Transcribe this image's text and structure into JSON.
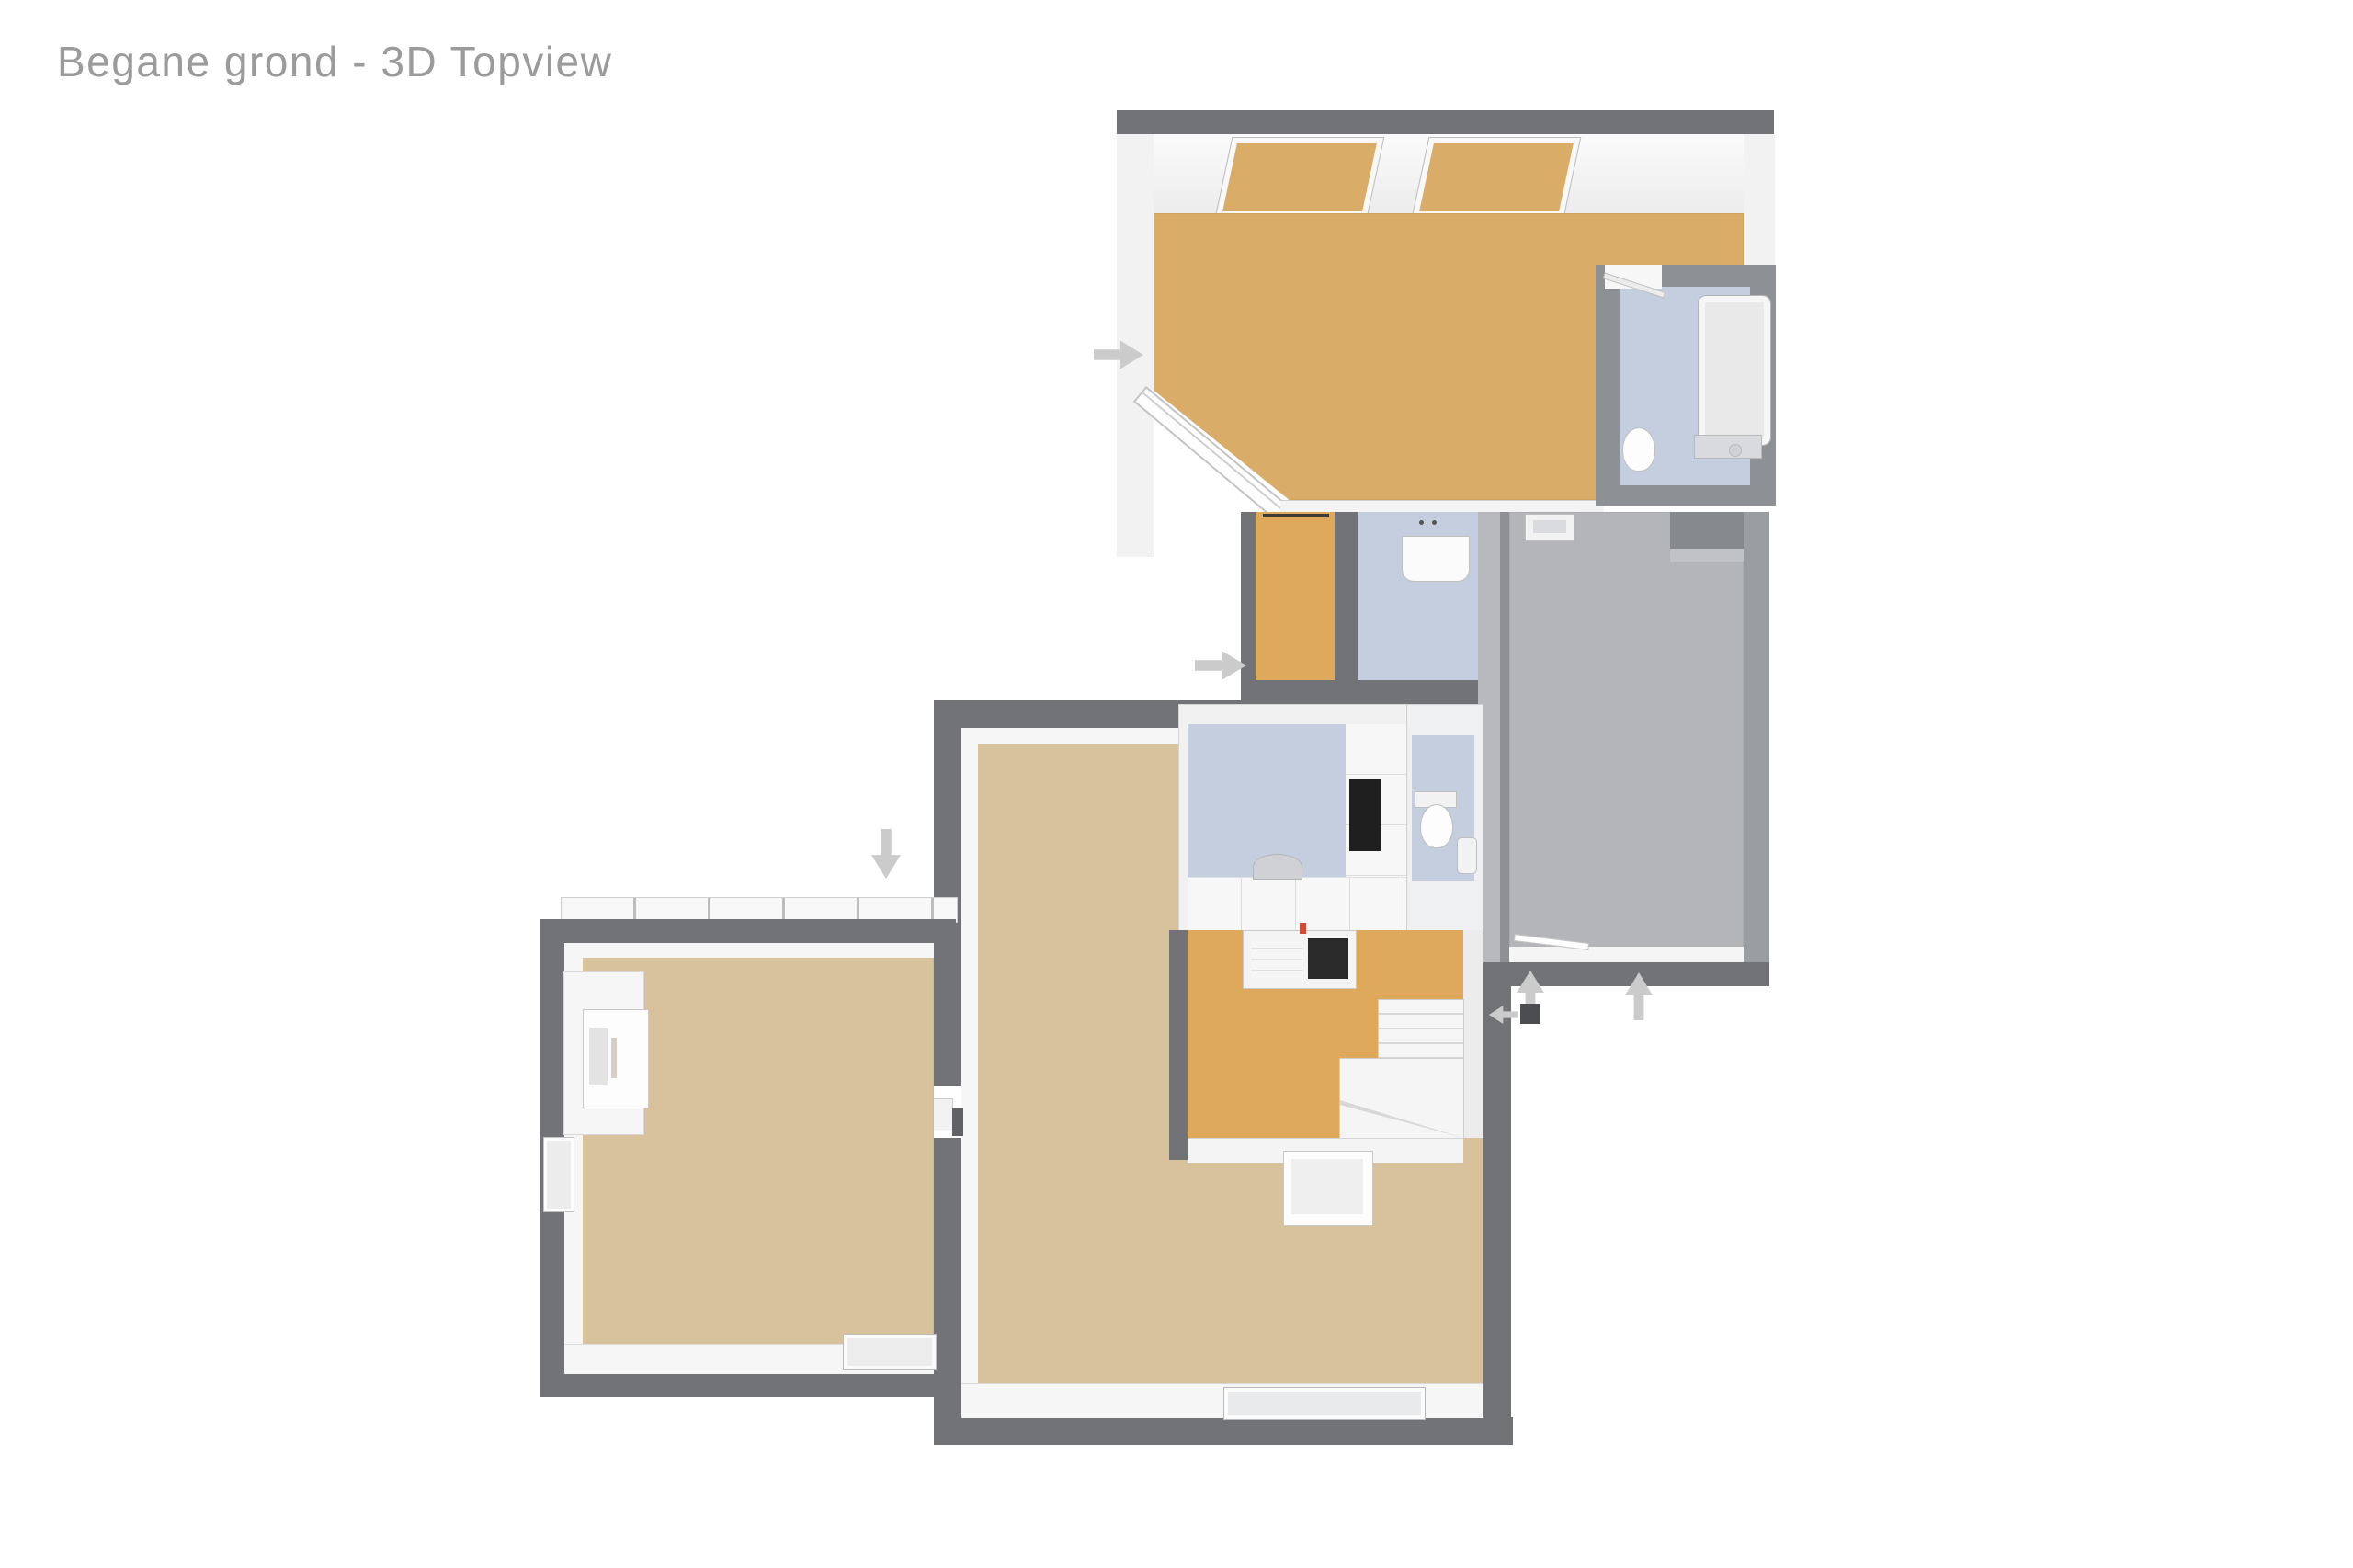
{
  "title": "Begane grond - 3D Topview",
  "palette": {
    "background": "#ffffff",
    "title_text": "#9b9b9b",
    "wall_dark": "#717377",
    "wall_medium": "#8d9094",
    "wall_light_gray": "#9a9da1",
    "floor_tan": "#d9ad68",
    "floor_orange": "#dfa95c",
    "floor_beige": "#d7c29b",
    "floor_blue": "#c4cedf",
    "floor_gray": "#b4b5b8",
    "arrow_gray": "#cbcbcb",
    "appliance_dark": "#1f1f1f",
    "door_marker_dark": "#4b4d50",
    "accent_red": "#cf4a38"
  },
  "floorplan": {
    "rooms": [
      {
        "name": "living-dining-room-top",
        "floor": "floor_tan"
      },
      {
        "name": "bathroom-top-right",
        "floor": "floor_blue"
      },
      {
        "name": "corridor-middle",
        "floor": "floor_orange"
      },
      {
        "name": "shower-utility-room",
        "floor": "floor_blue"
      },
      {
        "name": "garage-storage-room",
        "floor": "floor_gray"
      },
      {
        "name": "kitchen",
        "floor": "floor_blue"
      },
      {
        "name": "toilet-room",
        "floor": "floor_blue"
      },
      {
        "name": "hallway-with-stairs",
        "floor": "floor_orange"
      },
      {
        "name": "living-room-bottom",
        "floor": "floor_beige"
      },
      {
        "name": "side-room-bottom-left",
        "floor": "floor_beige"
      }
    ],
    "entrance_arrows": [
      {
        "name": "entrance-arrow-top-room",
        "direction": "right"
      },
      {
        "name": "entrance-arrow-corridor",
        "direction": "right"
      },
      {
        "name": "entrance-arrow-side-room",
        "direction": "down"
      },
      {
        "name": "entrance-arrow-garage-left",
        "direction": "up"
      },
      {
        "name": "entrance-arrow-front-door",
        "direction": "left"
      },
      {
        "name": "entrance-arrow-garage-right",
        "direction": "up"
      }
    ]
  }
}
